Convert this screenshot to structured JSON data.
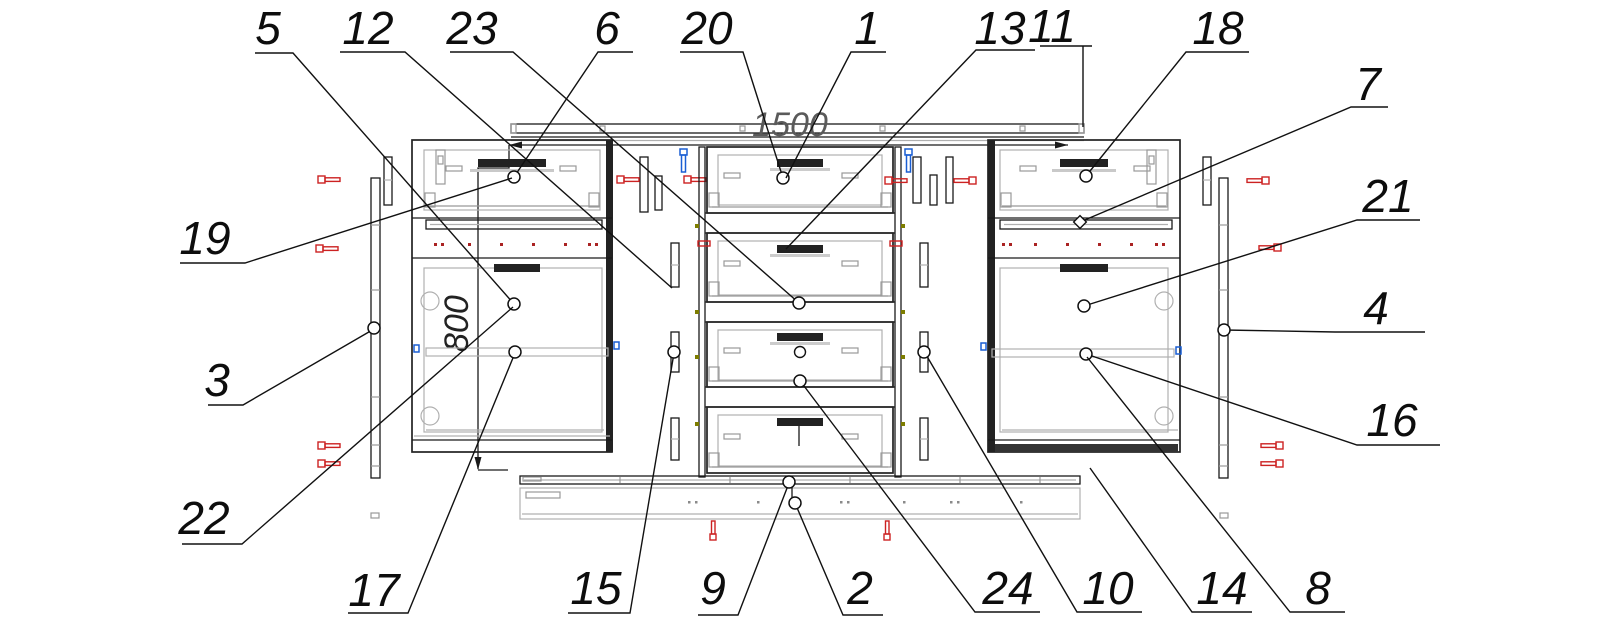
{
  "figure": {
    "type": "furniture-assembly-exploded-drawing",
    "dims": {
      "width_label": "1500",
      "height_label": "800"
    },
    "colors": {
      "line": "#1a1a1a",
      "detail_gray": "#b0b0b0",
      "fastener_red": "#cc2222",
      "fastener_blue": "#1a5fd4",
      "dot_olive": "#7d7d00",
      "dim_text": "#5a5a5a"
    },
    "callouts": [
      {
        "n": "5",
        "tx": 268,
        "ty": 44,
        "pts": [
          [
            255,
            53
          ],
          [
            293,
            53
          ],
          [
            514,
            304
          ]
        ],
        "m": "circle",
        "mx": 514,
        "my": 304
      },
      {
        "n": "12",
        "tx": 368,
        "ty": 44,
        "pts": [
          [
            340,
            52
          ],
          [
            405,
            52
          ],
          [
            672,
            288
          ]
        ],
        "m": null
      },
      {
        "n": "23",
        "tx": 472,
        "ty": 44,
        "pts": [
          [
            450,
            52
          ],
          [
            513,
            52
          ],
          [
            799,
            303
          ]
        ],
        "m": "circle",
        "mx": 799,
        "my": 303
      },
      {
        "n": "6",
        "tx": 607,
        "ty": 44,
        "pts": [
          [
            633,
            52
          ],
          [
            598,
            52
          ],
          [
            514,
            177
          ]
        ],
        "m": "circle",
        "mx": 514,
        "my": 177
      },
      {
        "n": "20",
        "tx": 707,
        "ty": 44,
        "pts": [
          [
            680,
            52
          ],
          [
            743,
            52
          ],
          [
            783,
            178
          ]
        ],
        "m": "circle",
        "mx": 783,
        "my": 178
      },
      {
        "n": "1",
        "tx": 867,
        "ty": 44,
        "pts": [
          [
            886,
            52
          ],
          [
            851,
            52
          ],
          [
            786,
            178
          ]
        ],
        "m": null
      },
      {
        "n": "13",
        "tx": 1000,
        "ty": 44,
        "pts": [
          [
            1035,
            50
          ],
          [
            976,
            50
          ],
          [
            786,
            249
          ]
        ],
        "m": null
      },
      {
        "n": "11",
        "tx": 1052,
        "ty": 42,
        "pts": [
          [
            1040,
            46
          ],
          [
            1092,
            46
          ],
          [
            1083,
            46
          ],
          [
            1083,
            127
          ]
        ],
        "m": null
      },
      {
        "n": "18",
        "tx": 1218,
        "ty": 44,
        "pts": [
          [
            1249,
            52
          ],
          [
            1186,
            52
          ],
          [
            1086,
            176
          ]
        ],
        "m": "circle",
        "mx": 1086,
        "my": 176
      },
      {
        "n": "7",
        "tx": 1368,
        "ty": 100,
        "pts": [
          [
            1388,
            107
          ],
          [
            1351,
            107
          ],
          [
            1080,
            222
          ]
        ],
        "m": "diamond",
        "mx": 1080,
        "my": 222
      },
      {
        "n": "21",
        "tx": 1388,
        "ty": 212,
        "pts": [
          [
            1420,
            220
          ],
          [
            1357,
            220
          ],
          [
            1084,
            306
          ]
        ],
        "m": "circle",
        "mx": 1084,
        "my": 306
      },
      {
        "n": "4",
        "tx": 1376,
        "ty": 324,
        "pts": [
          [
            1425,
            332
          ],
          [
            1335,
            332
          ],
          [
            1224,
            330
          ]
        ],
        "m": "circle",
        "mx": 1224,
        "my": 330
      },
      {
        "n": "16",
        "tx": 1392,
        "ty": 436,
        "pts": [
          [
            1440,
            445
          ],
          [
            1357,
            445
          ],
          [
            1086,
            354
          ]
        ],
        "m": "circle",
        "mx": 1086,
        "my": 354
      },
      {
        "n": "8",
        "tx": 1318,
        "ty": 604,
        "pts": [
          [
            1345,
            612
          ],
          [
            1290,
            612
          ],
          [
            1087,
            357
          ]
        ],
        "m": null
      },
      {
        "n": "14",
        "tx": 1222,
        "ty": 604,
        "pts": [
          [
            1252,
            612
          ],
          [
            1192,
            612
          ],
          [
            1090,
            468
          ]
        ],
        "m": null
      },
      {
        "n": "10",
        "tx": 1108,
        "ty": 604,
        "pts": [
          [
            1142,
            612
          ],
          [
            1077,
            612
          ],
          [
            925,
            353
          ]
        ],
        "m": "circle",
        "mx": 924,
        "my": 352
      },
      {
        "n": "24",
        "tx": 1008,
        "ty": 604,
        "pts": [
          [
            1040,
            612
          ],
          [
            975,
            612
          ],
          [
            801,
            382
          ]
        ],
        "m": "circle",
        "mx": 800,
        "my": 381
      },
      {
        "n": "2",
        "tx": 860,
        "ty": 604,
        "pts": [
          [
            883,
            615
          ],
          [
            843,
            615
          ],
          [
            795,
            503
          ]
        ],
        "m": "circle",
        "mx": 795,
        "my": 503
      },
      {
        "n": "9",
        "tx": 713,
        "ty": 604,
        "pts": [
          [
            698,
            615
          ],
          [
            738,
            615
          ],
          [
            789,
            483
          ]
        ],
        "m": "circle",
        "mx": 789,
        "my": 482
      },
      {
        "n": "15",
        "tx": 596,
        "ty": 604,
        "pts": [
          [
            568,
            613
          ],
          [
            630,
            613
          ],
          [
            674,
            353
          ]
        ],
        "m": "circle",
        "mx": 674,
        "my": 352
      },
      {
        "n": "17",
        "tx": 374,
        "ty": 606,
        "pts": [
          [
            348,
            613
          ],
          [
            408,
            613
          ],
          [
            515,
            353
          ]
        ],
        "m": "circle",
        "mx": 515,
        "my": 352
      },
      {
        "n": "22",
        "tx": 204,
        "ty": 534,
        "pts": [
          [
            182,
            544
          ],
          [
            242,
            544
          ],
          [
            513,
            307
          ]
        ],
        "m": null
      },
      {
        "n": "3",
        "tx": 217,
        "ty": 396,
        "pts": [
          [
            208,
            405
          ],
          [
            243,
            405
          ],
          [
            374,
            329
          ]
        ],
        "m": "circle",
        "mx": 374,
        "my": 328
      },
      {
        "n": "19",
        "tx": 205,
        "ty": 254,
        "pts": [
          [
            180,
            263
          ],
          [
            245,
            263
          ],
          [
            512,
            178
          ]
        ],
        "m": null
      }
    ]
  }
}
